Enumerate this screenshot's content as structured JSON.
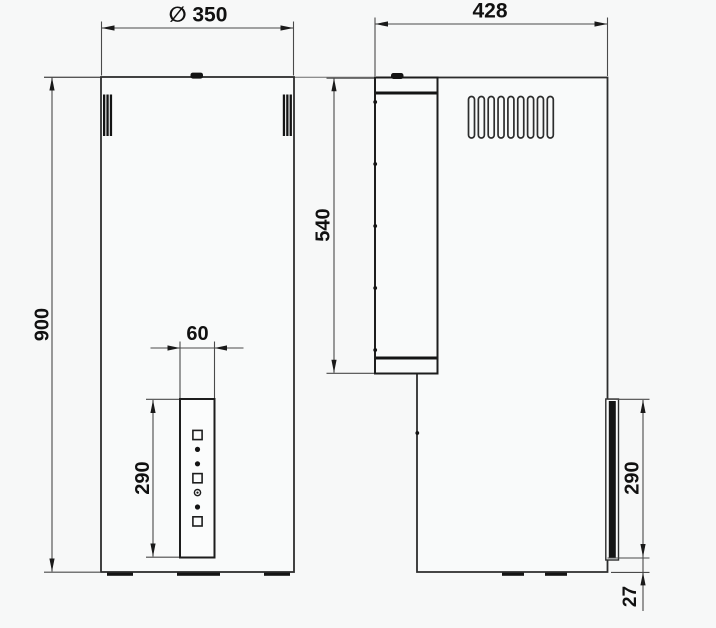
{
  "drawing": {
    "colors": {
      "background": "#f7f8f8",
      "object_line": "#2d2d2d",
      "dimension_line": "#4a4a4a",
      "text": "#111111",
      "feature_black": "#141414"
    },
    "dimensions": {
      "front_width": "∅ 350",
      "front_height": "900",
      "panel_width": "60",
      "panel_height_front": "290",
      "side_depth": "428",
      "duct_height": "540",
      "panel_height_side": "290",
      "panel_bottom_offset": "27"
    },
    "front_view": {
      "control_panel_symbols": [
        "square",
        "dot",
        "dot",
        "square",
        "ring",
        "dot",
        "square"
      ]
    },
    "side_view": {
      "vent_slot_count": 9,
      "duct_screw_count": 5
    }
  }
}
